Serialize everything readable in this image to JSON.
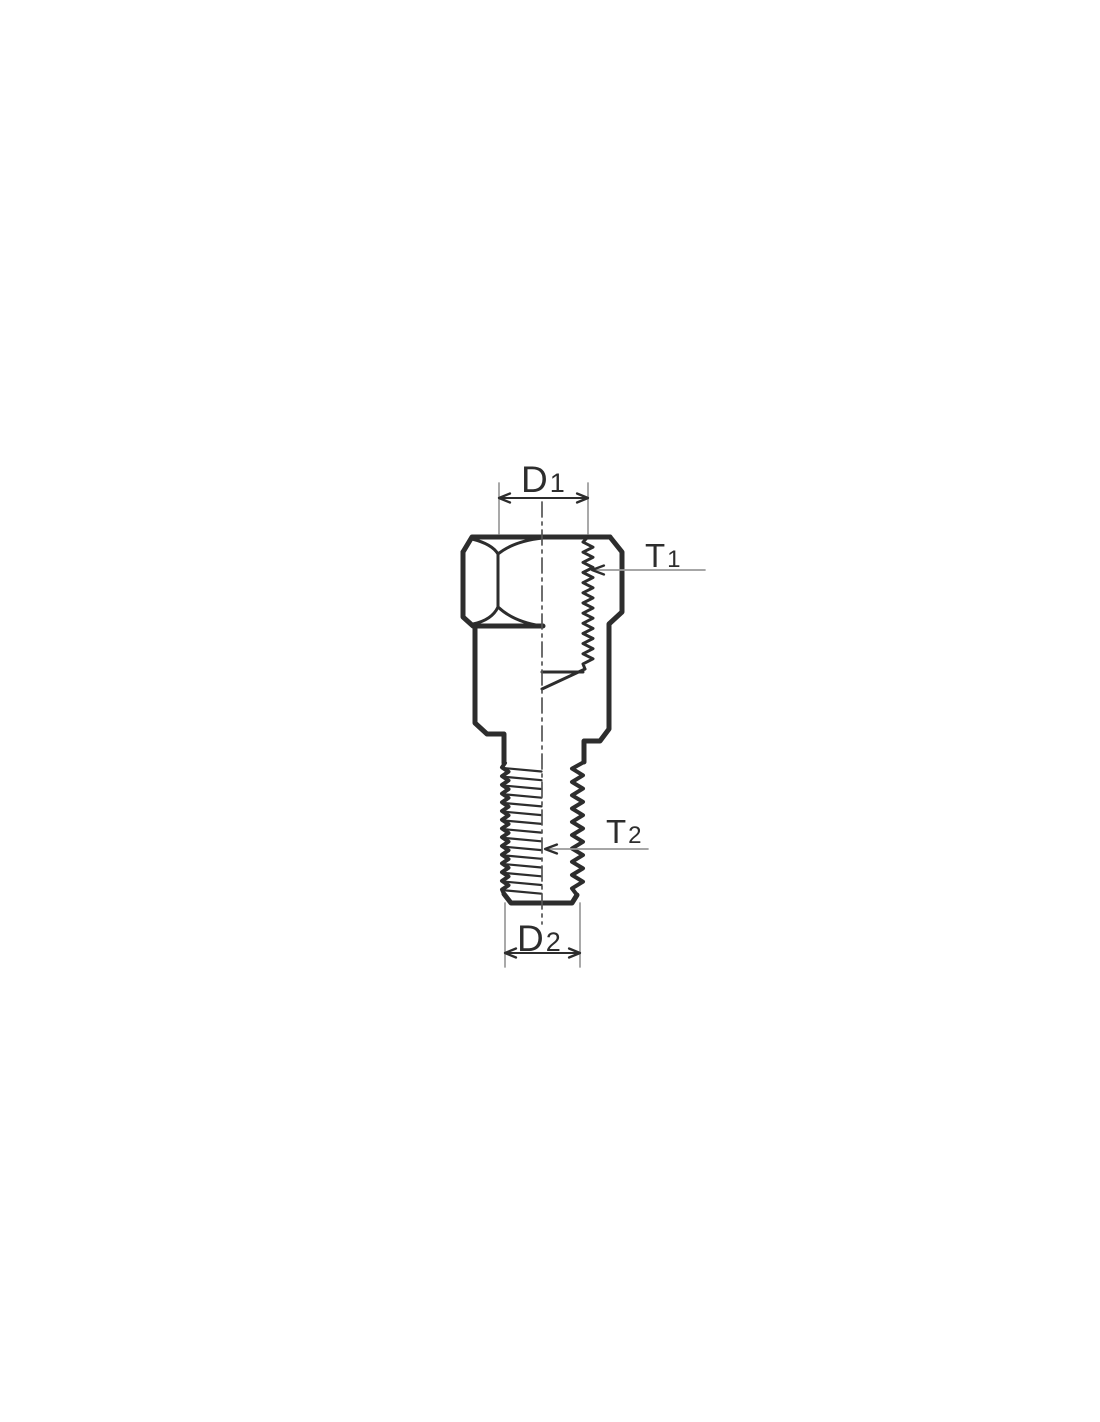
{
  "diagram": {
    "labels": {
      "d1": {
        "main": "D",
        "sub": "1"
      },
      "t1": {
        "main": "T",
        "sub": "1"
      },
      "t2": {
        "main": "T",
        "sub": "2"
      },
      "d2": {
        "main": "D",
        "sub": "2"
      }
    },
    "colors": {
      "outline": "#2d2d2d",
      "section_fill": "#c9c9c9",
      "thin_line": "#9a9a9a",
      "centerline": "#555555",
      "text": "#2d2d2d",
      "background": "#ffffff"
    }
  }
}
